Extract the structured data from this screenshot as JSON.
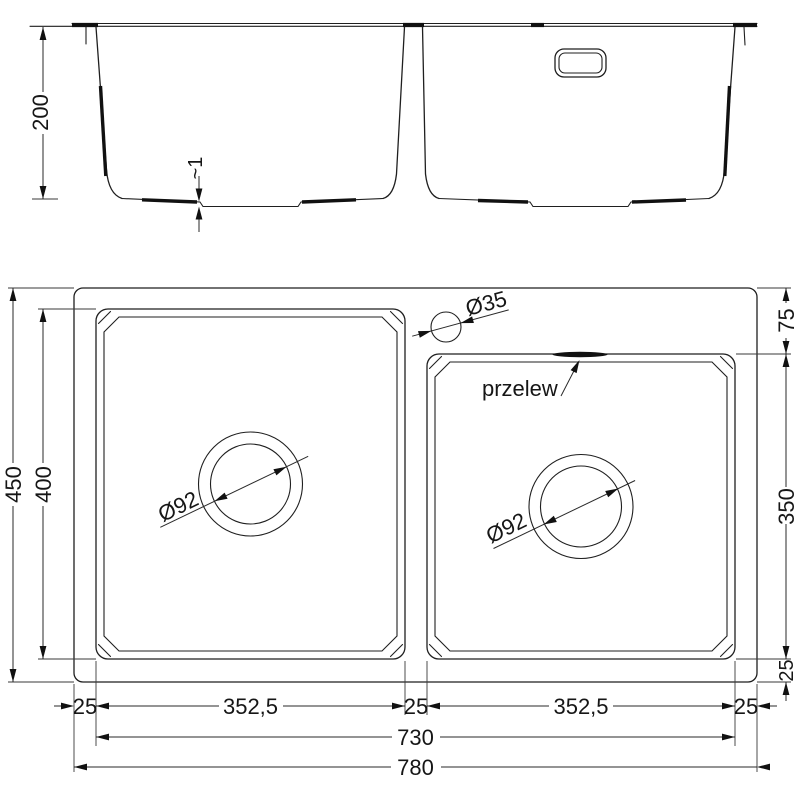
{
  "elevation": {
    "depth": "200",
    "bottom_step": "~1"
  },
  "plan": {
    "left_side": {
      "overall_depth": "450",
      "left_bowl_depth": "400"
    },
    "right_side": {
      "top_offset": "75",
      "right_bowl_depth": "350",
      "bottom_offset": "25"
    },
    "bottom": {
      "left_edge": "25",
      "left_bowl_width": "352,5",
      "middle_gap": "25",
      "right_bowl_width": "352,5",
      "right_edge": "25",
      "bowls_span": "730",
      "overall_width": "780"
    },
    "drain_left": "Ø92",
    "drain_right": "Ø92",
    "tap_hole": "Ø35",
    "overflow_label": "przelew"
  }
}
